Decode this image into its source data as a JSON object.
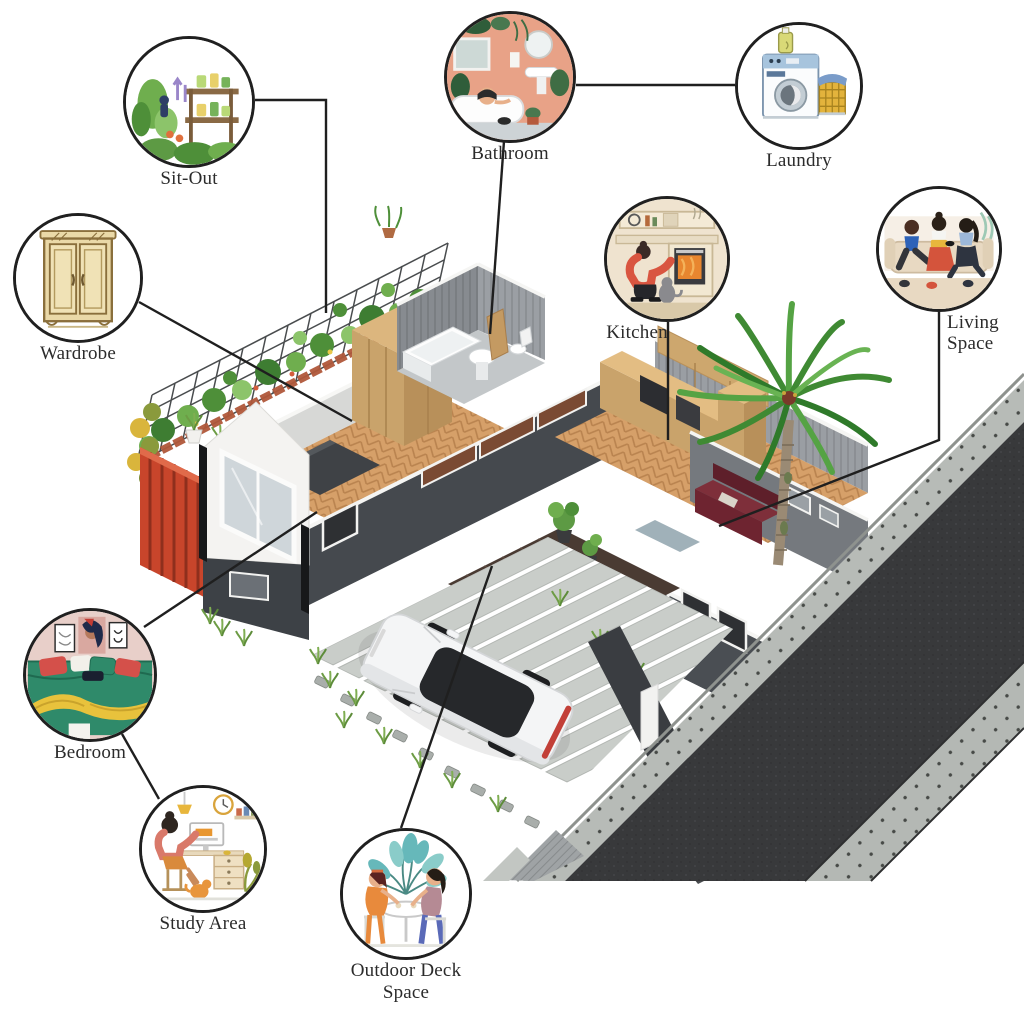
{
  "diagram": {
    "type": "isometric-house-plan-callouts",
    "subject": "L-shaped container tiny house with garden trellis, carport with white car, palm tree and street"
  },
  "callouts": {
    "sitout": {
      "label": "Sit-Out"
    },
    "wardrobe": {
      "label": "Wardrobe"
    },
    "bathroom": {
      "label": "Bathroom"
    },
    "laundry": {
      "label": "Laundry"
    },
    "kitchen": {
      "label": "Kitchen"
    },
    "living": {
      "label": "Living Space"
    },
    "bedroom": {
      "label": "Bedroom"
    },
    "study": {
      "label": "Study Area"
    },
    "deck": {
      "label": "Outdoor Deck Space"
    }
  },
  "colors": {
    "background": "#ffffff",
    "leader_line": "#1f1f1f",
    "label_text": "#2b2b2b",
    "wall_dark": "#45494e",
    "wood_floor": "#d29a62",
    "wood_cabinet": "#c9a36b",
    "deck_wood": "#4a3b33",
    "accent_purple": "#a79ab2",
    "sofa_maroon": "#6e2430",
    "asphalt": "#38393b",
    "paver": "#b7bbb7",
    "palm_green": "#3f8a33",
    "fence_red": "#c8452b"
  }
}
